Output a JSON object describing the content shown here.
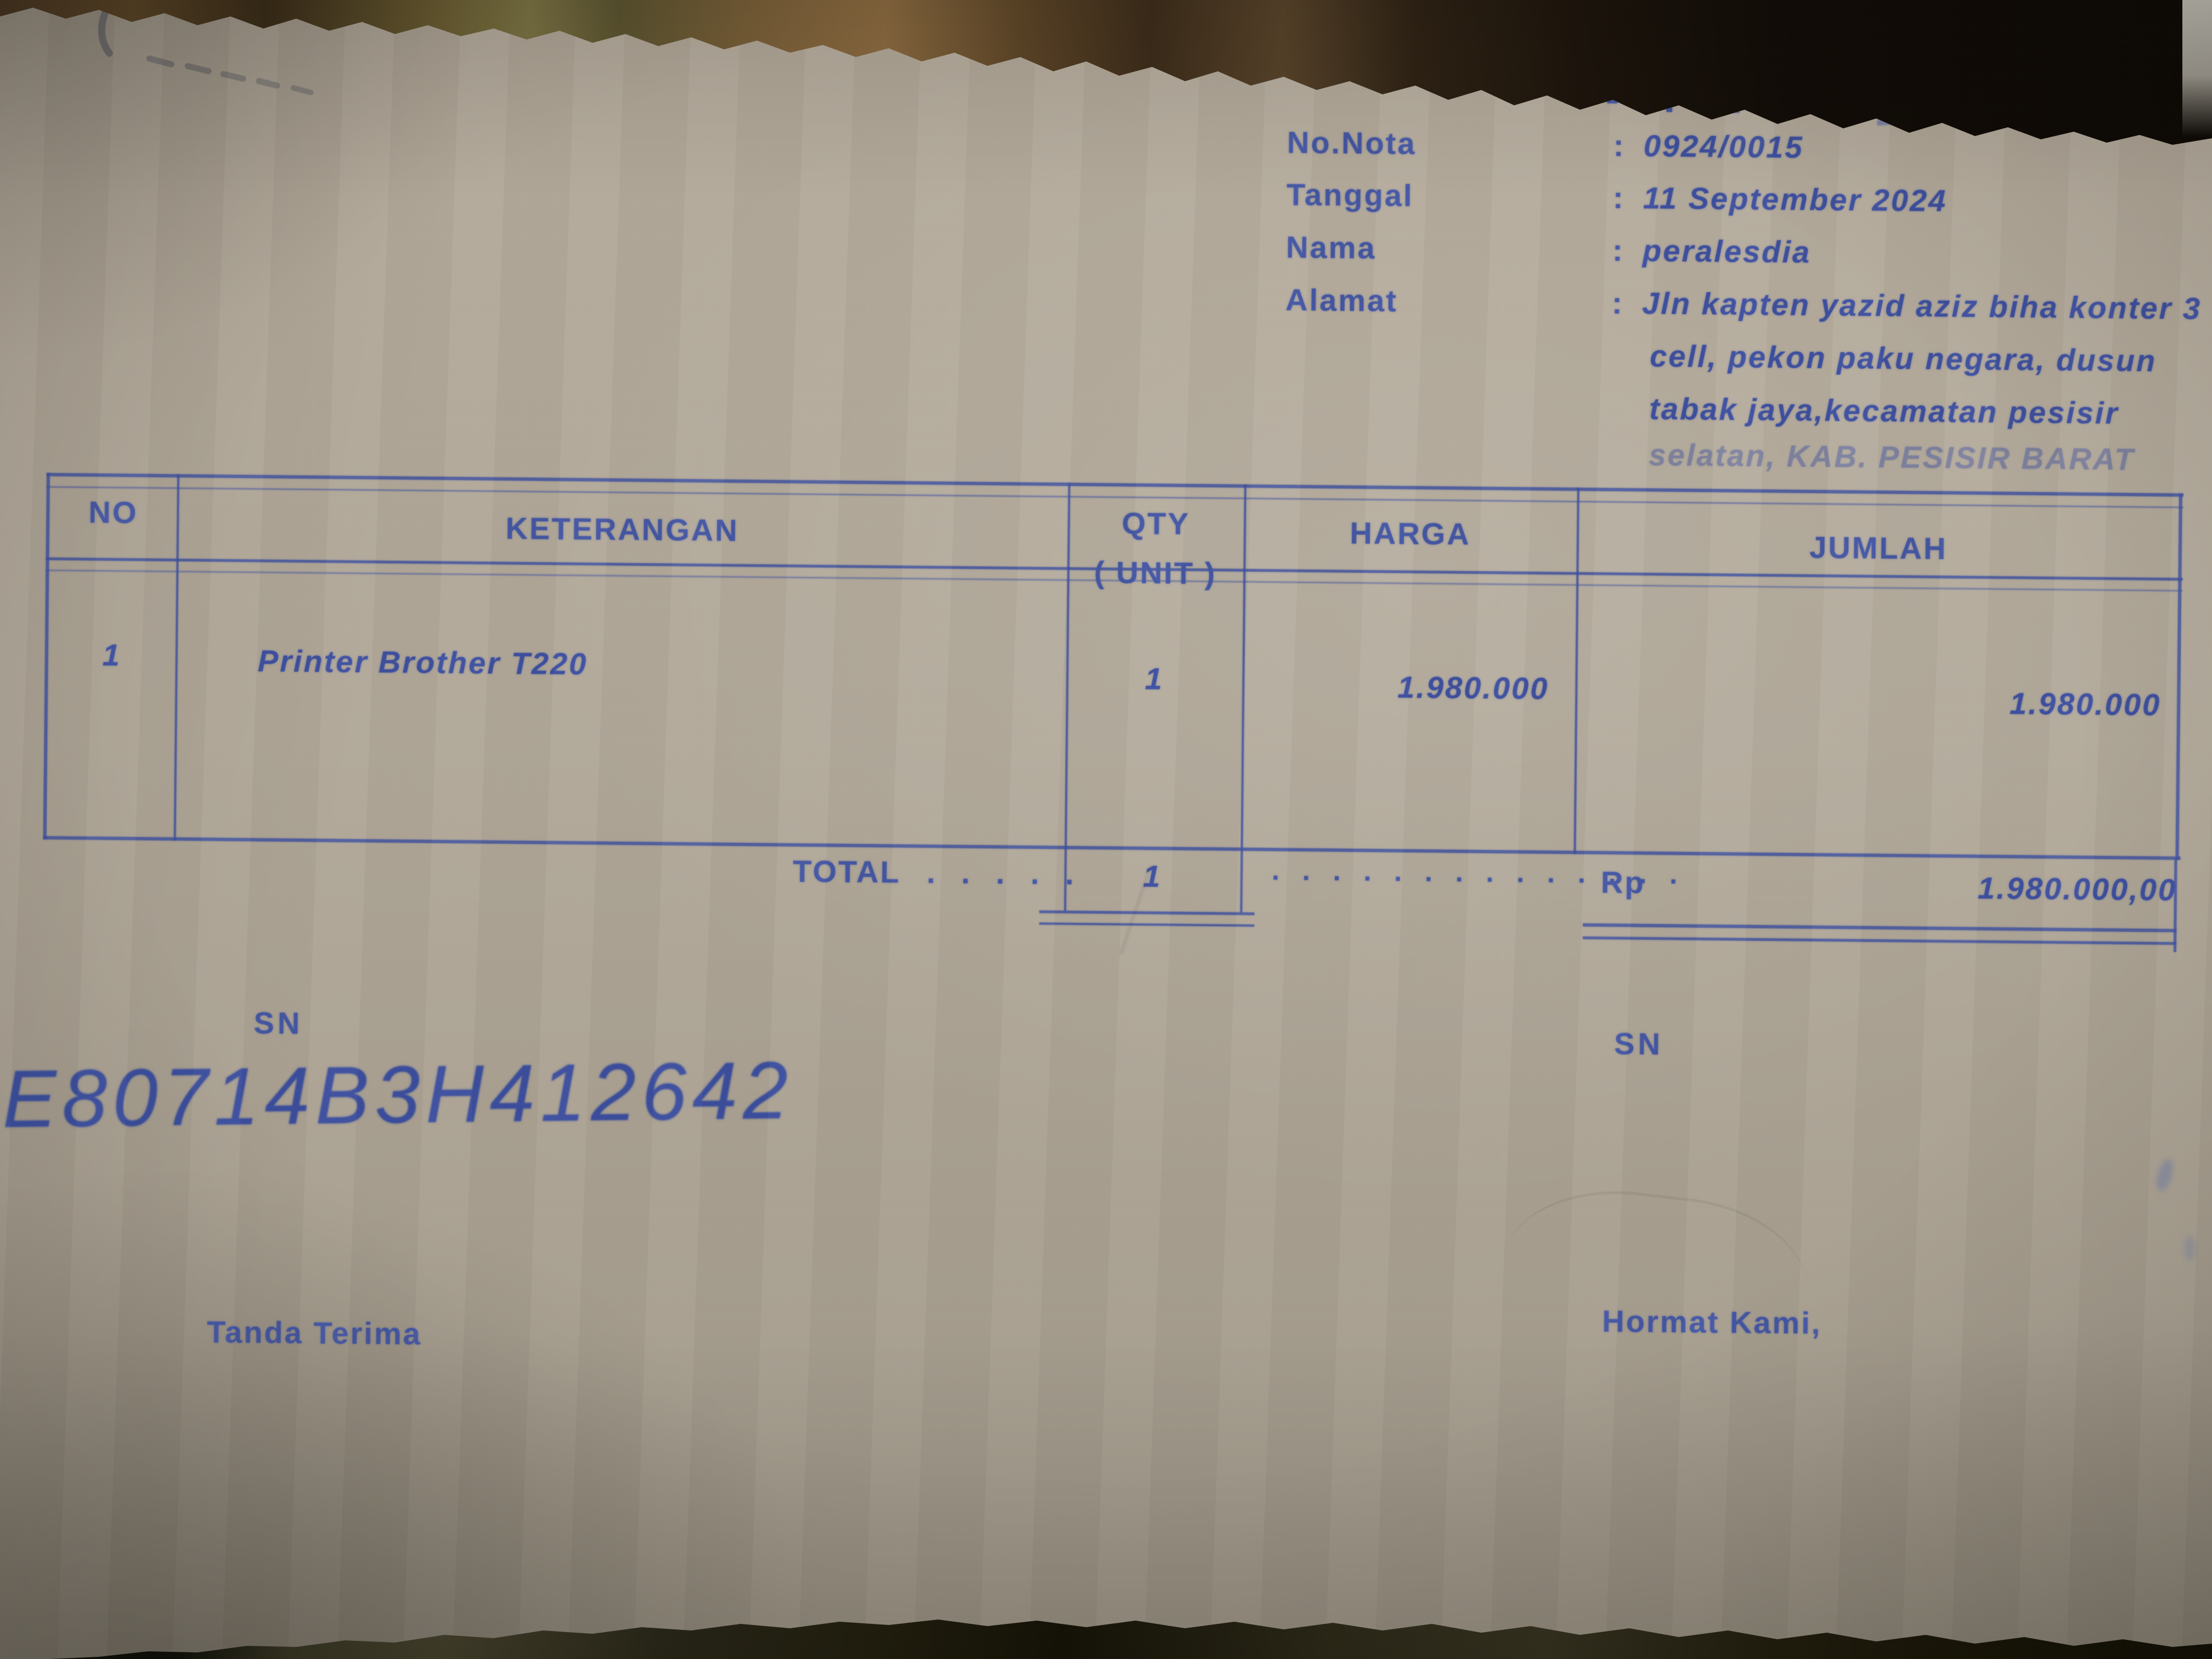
{
  "colors": {
    "ink_blue": "#4356a2",
    "handwriting_blue": "#3c4f9e",
    "paper": "#b0a799",
    "wood_dark": "#2c1f12"
  },
  "header": {
    "title": "-- F A K T U R --",
    "colon": ":",
    "no_nota_label": "No.Nota",
    "no_nota_value": "0924/0015",
    "tanggal_label": "Tanggal",
    "tanggal_value": "11 September 2024",
    "nama_label": "Nama",
    "nama_value": "peralesdia",
    "alamat_label": "Alamat",
    "alamat_lines": [
      "Jln kapten yazid aziz biha konter 3",
      "cell, pekon paku negara, dusun",
      "tabak jaya,kecamatan pesisir",
      "selatan, KAB. PESISIR BARAT"
    ]
  },
  "table": {
    "headers": {
      "no": "NO",
      "keterangan": "KETERANGAN",
      "qty_line1": "QTY",
      "qty_line2": "( UNIT )",
      "harga": "HARGA",
      "jumlah": "JUMLAH"
    },
    "rows": [
      {
        "no": "1",
        "keterangan": "Printer Brother T220",
        "qty": "1",
        "harga": "1.980.000",
        "jumlah": "1.980.000"
      }
    ],
    "total": {
      "label": "TOTAL",
      "label_dots": ". . . . .",
      "qty": "1",
      "mid_dots": ". . . . . . . . . . . . . .",
      "currency": "Rp",
      "amount": "1.980.000,00"
    }
  },
  "footer": {
    "sn_left_label": "SN",
    "sn_right_label": "SN",
    "serial_number_handwritten": "E80714B3H412642",
    "tanda_terima": "Tanda Terima",
    "hormat_kami": "Hormat Kami,"
  }
}
